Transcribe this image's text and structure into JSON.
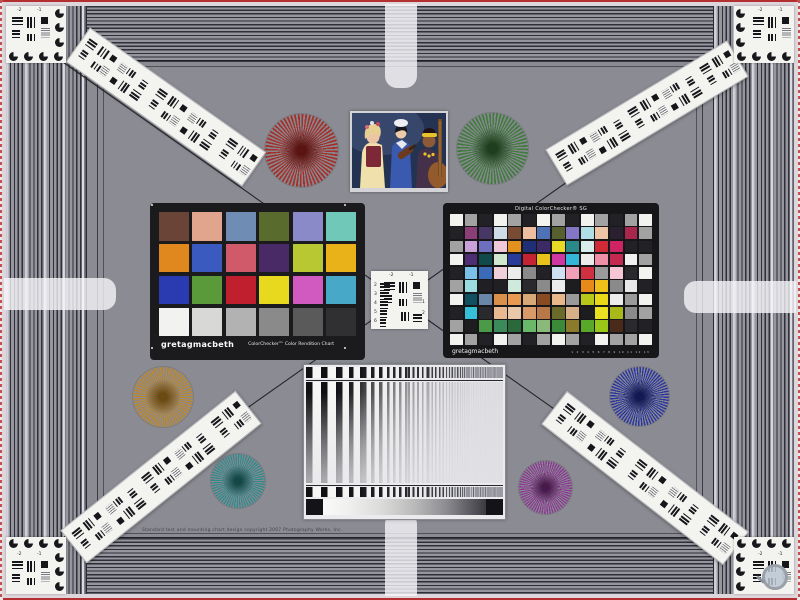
{
  "scene": {
    "field_color": "#8b8b93",
    "band_line_color": "#2f2f39",
    "border_color": "#b43030",
    "diagonal_line_color": "#26262e"
  },
  "fine_print": "Standard test and mounting chart design copyright 2007 Photography Works, Inc.",
  "colorchecker": {
    "brand": "gretagmacbeth",
    "title": "ColorChecker™ Color Rendition Chart",
    "patches": [
      "#6b4438",
      "#e0a58c",
      "#6f8cb5",
      "#5a6b2e",
      "#8a8ac8",
      "#6fc8b8",
      "#e0881e",
      "#3a5ac0",
      "#d05a6a",
      "#4a2a66",
      "#b8c832",
      "#e8b218",
      "#2a3ab0",
      "#5a9a3a",
      "#c0202e",
      "#e8d81e",
      "#d05ac0",
      "#48a8c8",
      "#f2f2f0",
      "#d8d8d6",
      "#b2b2b2",
      "#8a8a8a",
      "#5a5a5a",
      "#303032"
    ]
  },
  "sg": {
    "title": "Digital ColorChecker® SG",
    "brand": "gretagmacbeth",
    "ruler": "1 2 3 4 5 6 7 8 9 10 11 12 13",
    "rows": [
      [
        "#f2f2ee",
        "#a2a2a2",
        "#222226",
        "#f2f2ee",
        "#a2a2a2",
        "#222226",
        "#f2f2ee",
        "#a2a2a2",
        "#222226",
        "#f2f2ee",
        "#a2a2a2",
        "#222226",
        "#a2a2a2",
        "#f2f2ee"
      ],
      [
        "#222226",
        "#8c3f77",
        "#463863",
        "#cfdce8",
        "#7a4b33",
        "#edbfa0",
        "#4f71b5",
        "#56602e",
        "#8377c5",
        "#aee0e6",
        "#eec5a4",
        "#2a2030",
        "#a8274d",
        "#a2a2a2"
      ],
      [
        "#a2a2a2",
        "#c9a0d8",
        "#6f6fc0",
        "#f0c8d8",
        "#e2901e",
        "#1f2f77",
        "#3c2a66",
        "#e8d926",
        "#2a8a8a",
        "#d8ecec",
        "#cf2a35",
        "#cf2464",
        "#222226",
        "#222226"
      ],
      [
        "#f2f2ee",
        "#4f2d73",
        "#104a4a",
        "#cfe8cf",
        "#2a3a9a",
        "#c42333",
        "#e8c21a",
        "#d037a0",
        "#35b5d8",
        "#ececec",
        "#f090a8",
        "#c42a50",
        "#f0f0f0",
        "#a2a2a2"
      ],
      [
        "#222226",
        "#7ac0e8",
        "#3a6ab8",
        "#f0d0d8",
        "#ececec",
        "#8a8a8a",
        "#222226",
        "#cfe0f0",
        "#f0a0b8",
        "#d03040",
        "#9a9a9a",
        "#f5c7d4",
        "#2a2a2e",
        "#f2f2ee"
      ],
      [
        "#a2a2a2",
        "#9adce0",
        "#202024",
        "#202024",
        "#cfeadc",
        "#2a2a2e",
        "#8a8a8a",
        "#ececec",
        "#1d1d20",
        "#e88a1a",
        "#f0c018",
        "#8a8a8a",
        "#e8e8e8",
        "#222226"
      ],
      [
        "#f2f2ee",
        "#105060",
        "#6a86a8",
        "#d8904a",
        "#e89a52",
        "#d8a878",
        "#8a4a22",
        "#e8b88a",
        "#9a9a9a",
        "#b8c818",
        "#e8d818",
        "#ececec",
        "#9a9a9a",
        "#f2f2ee"
      ],
      [
        "#222226",
        "#35c0d8",
        "#2a2a2e",
        "#e8b890",
        "#e8c8a8",
        "#d89a68",
        "#b87848",
        "#6a6a2a",
        "#d8b088",
        "#1d1d20",
        "#e8e020",
        "#a8b818",
        "#8a8a8a",
        "#a2a2a2"
      ],
      [
        "#a2a2a2",
        "#1d1d20",
        "#4a9a4a",
        "#3a8a5a",
        "#2a6a3a",
        "#6ab86a",
        "#8aba7a",
        "#3a8a3a",
        "#8a7a2a",
        "#5aa82a",
        "#9ac818",
        "#4a2a1a",
        "#2a2a2e",
        "#222226"
      ],
      [
        "#f2f2ee",
        "#a2a2a2",
        "#222226",
        "#f2f2ee",
        "#a2a2a2",
        "#222226",
        "#a2a2a2",
        "#f2f2ee",
        "#a2a2a2",
        "#222226",
        "#f2f2ee",
        "#a2a2a2",
        "#a2a2a2",
        "#f2f2ee"
      ]
    ]
  },
  "usaf": {
    "top": [
      "-2",
      "-1"
    ],
    "left": [
      "2",
      "3",
      "4",
      "5",
      "6"
    ],
    "right": [
      "1",
      "2"
    ]
  },
  "stars": [
    {
      "name": "siemens-star-red",
      "x": 301,
      "y": 150,
      "d": 73,
      "color": "#a5302a",
      "core": "#5a1512"
    },
    {
      "name": "siemens-star-green",
      "x": 492,
      "y": 148,
      "d": 71,
      "color": "#3f7c3c",
      "core": "#1d3d1c"
    },
    {
      "name": "siemens-star-orange",
      "x": 163,
      "y": 397,
      "d": 60,
      "color": "#c08a2c",
      "core": "#6b4a14"
    },
    {
      "name": "siemens-star-teal",
      "x": 238,
      "y": 481,
      "d": 54,
      "color": "#2c8c8c",
      "core": "#154747"
    },
    {
      "name": "siemens-star-blue",
      "x": 639,
      "y": 396,
      "d": 59,
      "color": "#2a35a0",
      "core": "#131a52"
    },
    {
      "name": "siemens-star-purple",
      "x": 545,
      "y": 487,
      "d": 53,
      "color": "#8e3494",
      "core": "#471a4b"
    }
  ],
  "strips": [
    {
      "x": 165,
      "y": 106,
      "len": 214,
      "angle": 35.3,
      "n": 5
    },
    {
      "x": 646,
      "y": 112,
      "len": 210,
      "angle": -31,
      "n": 5
    },
    {
      "x": 160,
      "y": 476,
      "len": 222,
      "angle": -38.6,
      "n": 5
    },
    {
      "x": 644,
      "y": 477,
      "len": 228,
      "angle": 37.8,
      "n": 5
    }
  ]
}
